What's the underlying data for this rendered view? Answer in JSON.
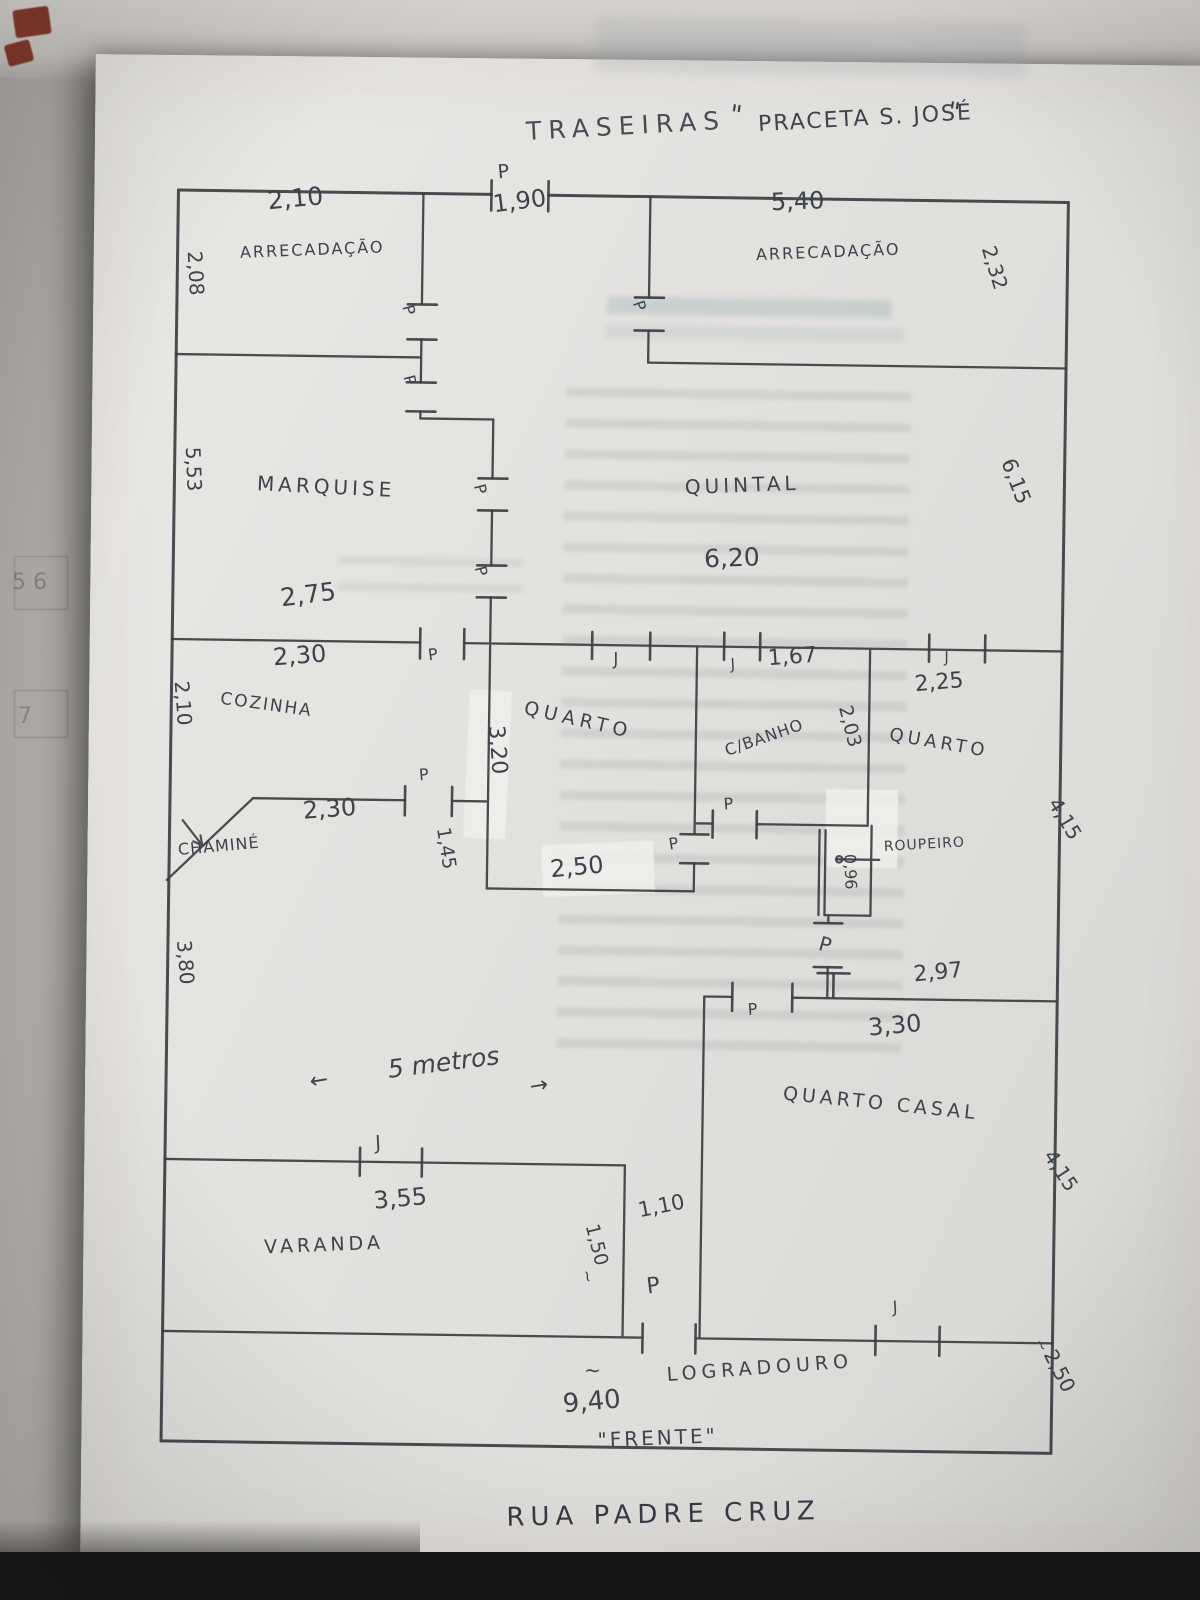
{
  "document": {
    "kind": "hand-drawn house floor plan sketch on paper",
    "back_label": "TRASEIRAS",
    "back_street": "PRACETA S. JOSÉ",
    "front_label": "\"FRENTE\"",
    "front_street": "RUA PADRE CRUZ",
    "front_width": "9,40"
  },
  "rooms": [
    {
      "name": "ARRECADAÇÃO",
      "width": "2,10",
      "depth": "2,08"
    },
    {
      "name": "ARRECADAÇÃO",
      "width": "5,40",
      "depth": "2,32"
    },
    {
      "name": "MARQUISE",
      "width": "2,75",
      "depth": "5,53"
    },
    {
      "name": "QUINTAL",
      "width": "6,20",
      "depth": "6,15"
    },
    {
      "name": "COZINHA",
      "width": "2,30",
      "depth": "2,10"
    },
    {
      "name": "QUARTO",
      "width": "2,50",
      "depth": "3,20"
    },
    {
      "name": "C/BANHO",
      "width": "1,67",
      "depth": "2,03"
    },
    {
      "name": "QUARTO",
      "width": "2,25",
      "depth": "4,15"
    },
    {
      "name": "QUARTO CASAL",
      "width": "3,30",
      "depth": "4,15"
    },
    {
      "name": "VARANDA",
      "width": "3,55"
    },
    {
      "name": "LOGRADOURO",
      "width": "9,40",
      "depth": "2,50"
    },
    {
      "name": "CHAMINÉ"
    },
    {
      "name": "ROUPEIRO",
      "width": "0,96"
    }
  ],
  "markers": {
    "door": "P",
    "window": "J"
  },
  "labels": [
    {
      "name": "bleed-number-5-6",
      "text": "5 6",
      "x": 12,
      "y": 572,
      "rot": 0,
      "fs": 22,
      "c": "rgba(80,84,90,0.45)",
      "layer": "bg"
    },
    {
      "name": "bleed-number-7",
      "text": "7",
      "x": 18,
      "y": 706,
      "rot": 0,
      "fs": 22,
      "c": "rgba(80,84,90,0.4)",
      "layer": "bg"
    },
    {
      "name": "annotation-traseiras",
      "text": "TRASEIRAS",
      "x": 516,
      "y": 120,
      "rot": -4,
      "fs": 25,
      "ls": 7,
      "c": "#464c55"
    },
    {
      "name": "annotation-praceta-quote-open",
      "text": "\"",
      "x": 722,
      "y": 100,
      "rot": 8,
      "fs": 26
    },
    {
      "name": "annotation-praceta",
      "text": "PRACETA  S. JOSÉ",
      "x": 748,
      "y": 112,
      "rot": -4,
      "fs": 22,
      "ls": 2
    },
    {
      "name": "annotation-praceta-quote-close",
      "text": "\"",
      "x": 940,
      "y": 94,
      "rot": 8,
      "fs": 26
    },
    {
      "name": "door-label-top-entrance",
      "text": "P",
      "x": 488,
      "y": 165,
      "rot": -6,
      "fs": 19
    },
    {
      "name": "dim-top-entrance",
      "text": "1,90",
      "x": 483,
      "y": 194,
      "rot": -8,
      "fs": 24
    },
    {
      "name": "dim-arrecadacao-left-width",
      "text": "2,10",
      "x": 258,
      "y": 193,
      "rot": -6,
      "fs": 25
    },
    {
      "name": "room-arrecadacao-left",
      "text": "ARRECADAÇÃO",
      "x": 232,
      "y": 250,
      "rot": -3,
      "fs": 16,
      "ls": 2
    },
    {
      "name": "dim-arrecadacao-left-depth",
      "text": "2,08",
      "x": 197,
      "y": 256,
      "rot": 86,
      "fs": 20
    },
    {
      "name": "dim-arrecadacao-right-width",
      "text": "5,40",
      "x": 762,
      "y": 188,
      "rot": -3,
      "fs": 24
    },
    {
      "name": "room-arrecadacao-right",
      "text": "ARRECADAÇÃO",
      "x": 748,
      "y": 245,
      "rot": -3,
      "fs": 16,
      "ls": 2
    },
    {
      "name": "dim-arrecadacao-right-depth",
      "text": "2,32",
      "x": 990,
      "y": 238,
      "rot": 72,
      "fs": 20
    },
    {
      "name": "dim-marquise-depth",
      "text": "5,53",
      "x": 198,
      "y": 452,
      "rot": 87,
      "fs": 20
    },
    {
      "name": "room-marquise",
      "text": "MARQUISE",
      "x": 253,
      "y": 478,
      "rot": 2,
      "fs": 20,
      "ls": 4
    },
    {
      "name": "door-label-marquise-upper",
      "text": "P",
      "x": 408,
      "y": 306,
      "rot": 75,
      "fs": 16
    },
    {
      "name": "door-label-marquise-lower",
      "text": "P",
      "x": 410,
      "y": 376,
      "rot": 75,
      "fs": 16
    },
    {
      "name": "door-label-quintal-west",
      "text": "P",
      "x": 638,
      "y": 298,
      "rot": 70,
      "fs": 16
    },
    {
      "name": "room-quintal",
      "text": "QUINTAL",
      "x": 680,
      "y": 476,
      "rot": -3,
      "fs": 20,
      "ls": 4
    },
    {
      "name": "dim-quintal-width",
      "text": "6,20",
      "x": 700,
      "y": 545,
      "rot": -3,
      "fs": 25
    },
    {
      "name": "dim-quintal-depth",
      "text": "6,15",
      "x": 1012,
      "y": 450,
      "rot": 68,
      "fs": 21
    },
    {
      "name": "door-label-corridor-upper",
      "text": "P",
      "x": 482,
      "y": 484,
      "rot": 75,
      "fs": 16
    },
    {
      "name": "door-label-corridor-lower",
      "text": "P",
      "x": 484,
      "y": 566,
      "rot": 75,
      "fs": 16
    },
    {
      "name": "dim-marquise-width",
      "text": "2,75",
      "x": 276,
      "y": 590,
      "rot": -8,
      "fs": 25
    },
    {
      "name": "dim-cozinha-width",
      "text": "2,30",
      "x": 270,
      "y": 650,
      "rot": -5,
      "fs": 24
    },
    {
      "name": "door-label-main-wall",
      "text": "P",
      "x": 425,
      "y": 650,
      "rot": -8,
      "fs": 16
    },
    {
      "name": "window-label-quarto-center",
      "text": "J",
      "x": 610,
      "y": 652,
      "rot": -12,
      "fs": 17,
      "it": 1
    },
    {
      "name": "window-label-banho",
      "text": "J",
      "x": 727,
      "y": 656,
      "rot": -15,
      "fs": 15,
      "it": 1
    },
    {
      "name": "dim-banho-width",
      "text": "1,67",
      "x": 765,
      "y": 646,
      "rot": -5,
      "fs": 22
    },
    {
      "name": "window-label-quarto-right",
      "text": "J",
      "x": 941,
      "y": 646,
      "rot": -12,
      "fs": 15,
      "it": 1
    },
    {
      "name": "dim-quarto-right-width",
      "text": "2,25",
      "x": 912,
      "y": 670,
      "rot": -6,
      "fs": 22
    },
    {
      "name": "room-cozinha",
      "text": "COZINHA",
      "x": 220,
      "y": 696,
      "rot": 7,
      "fs": 17,
      "ls": 2
    },
    {
      "name": "dim-cozinha-depth",
      "text": "2,10",
      "x": 190,
      "y": 686,
      "rot": 85,
      "fs": 20
    },
    {
      "name": "room-quarto-center",
      "text": "QUARTO",
      "x": 525,
      "y": 700,
      "rot": 12,
      "fs": 19,
      "ls": 5
    },
    {
      "name": "dim-quarto-center-depth",
      "text": "3,20",
      "x": 505,
      "y": 726,
      "rot": 85,
      "fs": 22
    },
    {
      "name": "room-banho",
      "text": "C/BANHO",
      "x": 722,
      "y": 742,
      "rot": -20,
      "fs": 16,
      "ls": 1
    },
    {
      "name": "dim-banho-depth",
      "text": "2,03",
      "x": 852,
      "y": 700,
      "rot": 75,
      "fs": 19
    },
    {
      "name": "room-quarto-right",
      "text": "QUARTO",
      "x": 890,
      "y": 722,
      "rot": 9,
      "fs": 18,
      "ls": 4
    },
    {
      "name": "dim-quarto-right-depth",
      "text": "4,15",
      "x": 1062,
      "y": 788,
      "rot": 58,
      "fs": 20
    },
    {
      "name": "dim-sala-north",
      "text": "2,30",
      "x": 302,
      "y": 803,
      "rot": -5,
      "fs": 24
    },
    {
      "name": "door-label-cozinha",
      "text": "P",
      "x": 418,
      "y": 770,
      "rot": -5,
      "fs": 16
    },
    {
      "name": "dim-hall-width",
      "text": "1,45",
      "x": 452,
      "y": 828,
      "rot": 80,
      "fs": 19
    },
    {
      "name": "room-chamine",
      "text": "CHAMINÉ",
      "x": 178,
      "y": 848,
      "rot": -6,
      "fs": 16,
      "ls": 1
    },
    {
      "name": "dim-quarto-center-width",
      "text": "2,50",
      "x": 550,
      "y": 858,
      "rot": -6,
      "fs": 24
    },
    {
      "name": "door-label-quarto-center",
      "text": "P",
      "x": 668,
      "y": 836,
      "rot": -10,
      "fs": 16
    },
    {
      "name": "door-label-banho",
      "text": "P",
      "x": 723,
      "y": 795,
      "rot": -5,
      "fs": 16
    },
    {
      "name": "room-roupeiro",
      "text": "ROUPEIRO",
      "x": 884,
      "y": 836,
      "rot": -4,
      "fs": 14,
      "ls": 1
    },
    {
      "name": "dim-roupeiro",
      "text": "0,96",
      "x": 858,
      "y": 850,
      "rot": 87,
      "fs": 16
    },
    {
      "name": "door-label-quarto-right",
      "text": "P",
      "x": 824,
      "y": 930,
      "rot": 15,
      "fs": 20
    },
    {
      "name": "dim-casal-north",
      "text": "2,97",
      "x": 915,
      "y": 960,
      "rot": -6,
      "fs": 22
    },
    {
      "name": "door-label-casal",
      "text": "P",
      "x": 750,
      "y": 1000,
      "rot": -5,
      "fs": 16
    },
    {
      "name": "dim-casal-width",
      "text": "3,30",
      "x": 870,
      "y": 1012,
      "rot": -6,
      "fs": 24
    },
    {
      "name": "room-quarto-casal",
      "text": "QUARTO CASAL",
      "x": 788,
      "y": 1082,
      "rot": 5,
      "fs": 19,
      "ls": 4
    },
    {
      "name": "dim-casal-depth",
      "text": "4,15",
      "x": 1062,
      "y": 1140,
      "rot": 56,
      "fs": 20
    },
    {
      "name": "dim-sala-depth",
      "text": "3,80",
      "x": 196,
      "y": 945,
      "rot": 85,
      "fs": 20
    },
    {
      "name": "annotation-arrow-left",
      "text": "←",
      "x": 312,
      "y": 1076,
      "rot": -10,
      "fs": 22
    },
    {
      "name": "annotation-5-metros",
      "text": "5 metros",
      "x": 390,
      "y": 1060,
      "rot": -8,
      "fs": 25,
      "it": 1
    },
    {
      "name": "annotation-arrow-right",
      "text": "→",
      "x": 532,
      "y": 1078,
      "rot": -10,
      "fs": 22
    },
    {
      "name": "window-label-varanda",
      "text": "J",
      "x": 378,
      "y": 1138,
      "rot": -15,
      "fs": 19,
      "it": 1
    },
    {
      "name": "dim-varanda-width",
      "text": "3,55",
      "x": 378,
      "y": 1192,
      "rot": -6,
      "fs": 24
    },
    {
      "name": "room-varanda",
      "text": "VARANDA",
      "x": 270,
      "y": 1243,
      "rot": -3,
      "fs": 19,
      "ls": 4
    },
    {
      "name": "dim-corridor-depth",
      "text": "1,50",
      "x": 606,
      "y": 1222,
      "rot": 75,
      "fs": 19
    },
    {
      "name": "dim-corridor-depth-approx",
      "text": "~",
      "x": 600,
      "y": 1268,
      "rot": 75,
      "fs": 16
    },
    {
      "name": "dim-corridor-width",
      "text": "1,10",
      "x": 642,
      "y": 1200,
      "rot": -12,
      "fs": 21
    },
    {
      "name": "door-label-corridor-exit",
      "text": "P",
      "x": 652,
      "y": 1276,
      "rot": -8,
      "fs": 22
    },
    {
      "name": "window-label-casal",
      "text": "J",
      "x": 898,
      "y": 1296,
      "rot": -15,
      "fs": 16,
      "it": 1
    },
    {
      "name": "room-logradouro",
      "text": "LOGRADOURO",
      "x": 674,
      "y": 1365,
      "rot": -5,
      "fs": 19,
      "ls": 5
    },
    {
      "name": "dim-front-approx",
      "text": "~",
      "x": 592,
      "y": 1360,
      "rot": 0,
      "fs": 20
    },
    {
      "name": "dim-front-width",
      "text": "9,40",
      "x": 570,
      "y": 1392,
      "rot": -6,
      "fs": 26
    },
    {
      "name": "dim-logradouro-depth",
      "text": "2,50",
      "x": 1066,
      "y": 1340,
      "rot": 62,
      "fs": 20
    },
    {
      "name": "dim-logradouro-depth-approx",
      "text": "~",
      "x": 1052,
      "y": 1330,
      "rot": 60,
      "fs": 15
    },
    {
      "name": "annotation-frente",
      "text": "\"FRENTE\"",
      "x": 606,
      "y": 1430,
      "rot": -3,
      "fs": 20,
      "ls": 3
    },
    {
      "name": "street-rua-padre-cruz",
      "text": "RUA PADRE CRUZ",
      "x": 516,
      "y": 1506,
      "rot": -2,
      "fs": 26,
      "ls": 6,
      "c": "#343a44"
    }
  ]
}
